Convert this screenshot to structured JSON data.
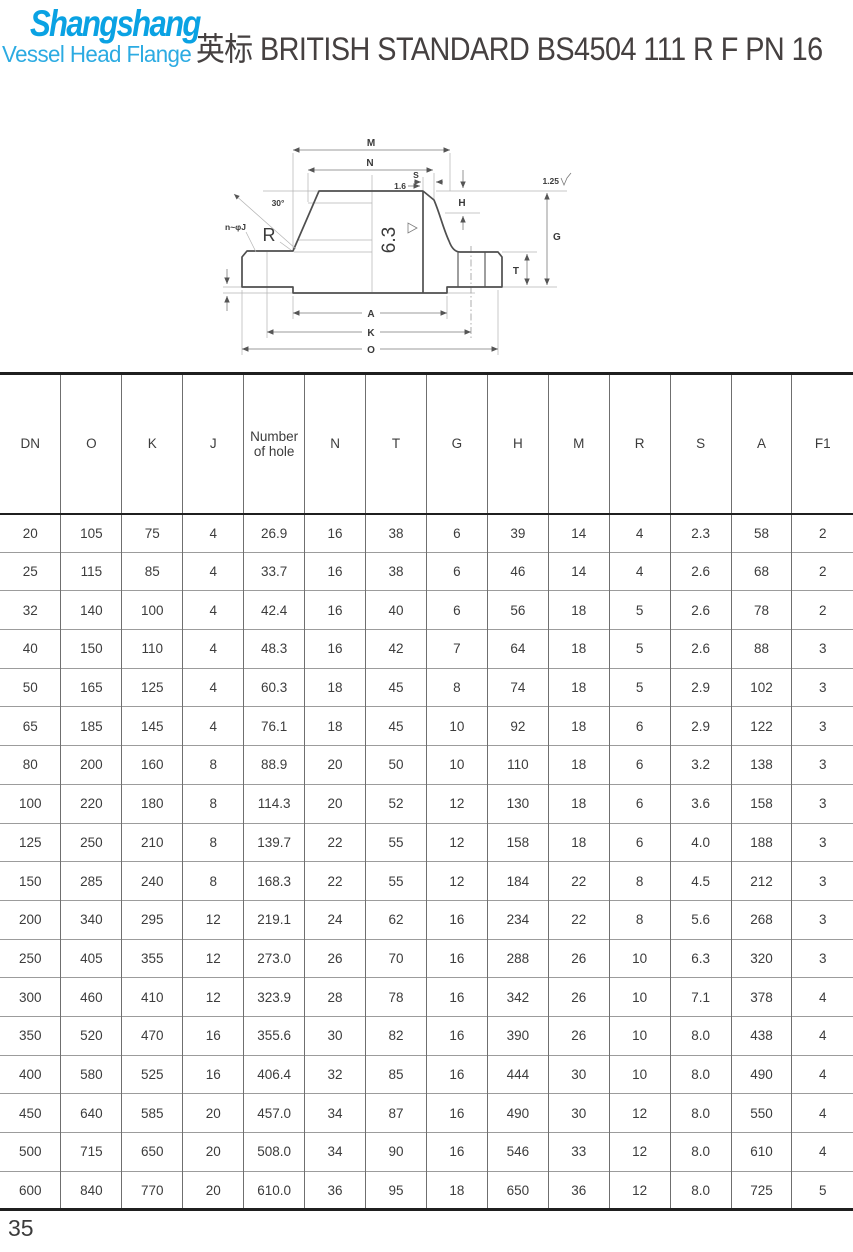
{
  "brand": {
    "name": "Shangshang",
    "tagline": "Vessel Head Flange",
    "brand_color": "#0aa2e3",
    "tagline_color": "#2cabe2"
  },
  "header": {
    "title": "英标 BRITISH STANDARD BS4504 111 R F PN 16",
    "title_color": "#454040"
  },
  "drawing": {
    "dim_m": "M",
    "dim_n": "N",
    "dim_s": "S",
    "surface_1_6": "1.6",
    "dim_h": "H",
    "dim_g": "G",
    "surface_1_25": "1.25",
    "angle_30": "30°",
    "bolt_label": "n~φJ",
    "radius_label": "R",
    "surface_6_3": "6.3",
    "dim_t": "T",
    "dim_a": "A",
    "dim_k": "K",
    "dim_o": "O"
  },
  "table": {
    "columns": [
      "DN",
      "O",
      "K",
      "J",
      "Number of hole",
      "N",
      "T",
      "G",
      "H",
      "M",
      "R",
      "S",
      "A",
      "F1"
    ],
    "rows": [
      [
        "20",
        "105",
        "75",
        "4",
        "26.9",
        "16",
        "38",
        "6",
        "39",
        "14",
        "4",
        "2.3",
        "58",
        "2"
      ],
      [
        "25",
        "115",
        "85",
        "4",
        "33.7",
        "16",
        "38",
        "6",
        "46",
        "14",
        "4",
        "2.6",
        "68",
        "2"
      ],
      [
        "32",
        "140",
        "100",
        "4",
        "42.4",
        "16",
        "40",
        "6",
        "56",
        "18",
        "5",
        "2.6",
        "78",
        "2"
      ],
      [
        "40",
        "150",
        "110",
        "4",
        "48.3",
        "16",
        "42",
        "7",
        "64",
        "18",
        "5",
        "2.6",
        "88",
        "3"
      ],
      [
        "50",
        "165",
        "125",
        "4",
        "60.3",
        "18",
        "45",
        "8",
        "74",
        "18",
        "5",
        "2.9",
        "102",
        "3"
      ],
      [
        "65",
        "185",
        "145",
        "4",
        "76.1",
        "18",
        "45",
        "10",
        "92",
        "18",
        "6",
        "2.9",
        "122",
        "3"
      ],
      [
        "80",
        "200",
        "160",
        "8",
        "88.9",
        "20",
        "50",
        "10",
        "110",
        "18",
        "6",
        "3.2",
        "138",
        "3"
      ],
      [
        "100",
        "220",
        "180",
        "8",
        "114.3",
        "20",
        "52",
        "12",
        "130",
        "18",
        "6",
        "3.6",
        "158",
        "3"
      ],
      [
        "125",
        "250",
        "210",
        "8",
        "139.7",
        "22",
        "55",
        "12",
        "158",
        "18",
        "6",
        "4.0",
        "188",
        "3"
      ],
      [
        "150",
        "285",
        "240",
        "8",
        "168.3",
        "22",
        "55",
        "12",
        "184",
        "22",
        "8",
        "4.5",
        "212",
        "3"
      ],
      [
        "200",
        "340",
        "295",
        "12",
        "219.1",
        "24",
        "62",
        "16",
        "234",
        "22",
        "8",
        "5.6",
        "268",
        "3"
      ],
      [
        "250",
        "405",
        "355",
        "12",
        "273.0",
        "26",
        "70",
        "16",
        "288",
        "26",
        "10",
        "6.3",
        "320",
        "3"
      ],
      [
        "300",
        "460",
        "410",
        "12",
        "323.9",
        "28",
        "78",
        "16",
        "342",
        "26",
        "10",
        "7.1",
        "378",
        "4"
      ],
      [
        "350",
        "520",
        "470",
        "16",
        "355.6",
        "30",
        "82",
        "16",
        "390",
        "26",
        "10",
        "8.0",
        "438",
        "4"
      ],
      [
        "400",
        "580",
        "525",
        "16",
        "406.4",
        "32",
        "85",
        "16",
        "444",
        "30",
        "10",
        "8.0",
        "490",
        "4"
      ],
      [
        "450",
        "640",
        "585",
        "20",
        "457.0",
        "34",
        "87",
        "16",
        "490",
        "30",
        "12",
        "8.0",
        "550",
        "4"
      ],
      [
        "500",
        "715",
        "650",
        "20",
        "508.0",
        "34",
        "90",
        "16",
        "546",
        "33",
        "12",
        "8.0",
        "610",
        "4"
      ],
      [
        "600",
        "840",
        "770",
        "20",
        "610.0",
        "36",
        "95",
        "18",
        "650",
        "36",
        "12",
        "8.0",
        "725",
        "5"
      ]
    ]
  },
  "footer": {
    "page_number": "35"
  }
}
